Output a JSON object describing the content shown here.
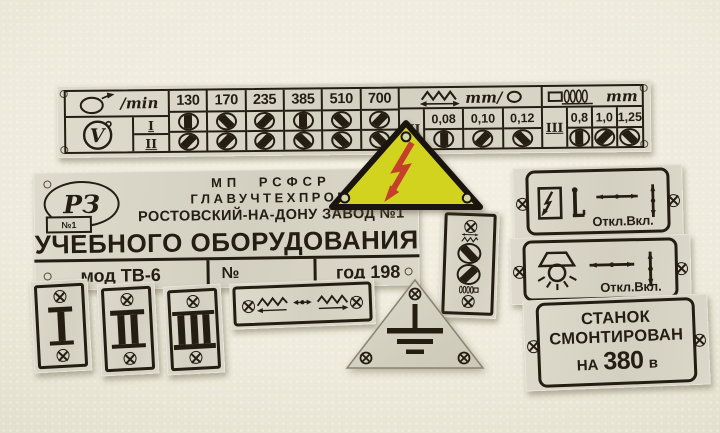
{
  "colors": {
    "background": "#eceadb",
    "plate_metal": "#d9d6c8",
    "ink": "#241d12",
    "warning_yellow": "#d2d31f",
    "warning_red": "#c4402a"
  },
  "speed_plate": {
    "rpm_unit": "/min",
    "pulley_letter": "V",
    "row_labels": [
      "I",
      "II"
    ],
    "speeds": [
      "130",
      "170",
      "235",
      "385",
      "510",
      "700"
    ],
    "row1_icons": [
      "v",
      "bs",
      "fs",
      "v",
      "bs",
      "fs"
    ],
    "row2_icons": [
      "fs",
      "fs",
      "fs",
      "bs",
      "bs",
      "bs"
    ],
    "feed_unit": "mm/",
    "feed_label": "III",
    "feed_values": [
      "0,08",
      "0,10",
      "0,12"
    ],
    "feed_icons": [
      "v",
      "fs",
      "bs"
    ],
    "thread_unit": "mm",
    "thread_label": "III",
    "thread_values": [
      "0,8",
      "1,0",
      "1,25"
    ],
    "thread_icons": [
      "v",
      "fs",
      "bs"
    ]
  },
  "nameplate": {
    "logo_main": "РЗ",
    "logo_sub": "№1",
    "org_line1": "МП РСФСР",
    "org_line2": "ГЛАВУЧТЕХПРОМ",
    "org_line3": "РОСТОВСКИЙ-НА-ДОНУ ЗАВОД №1",
    "title": "УЧЕБНОГО ОБОРУДОВАНИЯ",
    "model": "мод ТВ-6",
    "serial": "№",
    "year": "год 198"
  },
  "numeral_plates": [
    "I",
    "II",
    "III"
  ],
  "switch_plates": [
    {
      "label": "Откл.Вкл.",
      "icons": [
        "power-switch-box",
        "switch-lever",
        "handle-horizontal",
        "handle-vertical"
      ]
    },
    {
      "label": "Откл.Вкл.",
      "icons": [
        "work-lamp",
        "handle-horizontal",
        "handle-vertical"
      ]
    }
  ],
  "voltage_plate": {
    "line1": "СТАНОК",
    "line2": "СМОНТИРОВАН",
    "line3_prefix": "НА",
    "line3_value": "380",
    "line3_unit": "в"
  },
  "symbol_plate_icons": [
    "screw",
    "feed-travel-arrows",
    "pulley-diag-left",
    "pulley-diag-right",
    "lead-screw",
    "screw"
  ],
  "feed_direction_icons": [
    "screw",
    "feed-left-zigzag-arrow",
    "neutral-dot-arrows",
    "feed-right-zigzag-arrow",
    "screw"
  ],
  "warning_triangle_icon": "high-voltage-lightning",
  "ground_triangle_icon": "earth-ground"
}
